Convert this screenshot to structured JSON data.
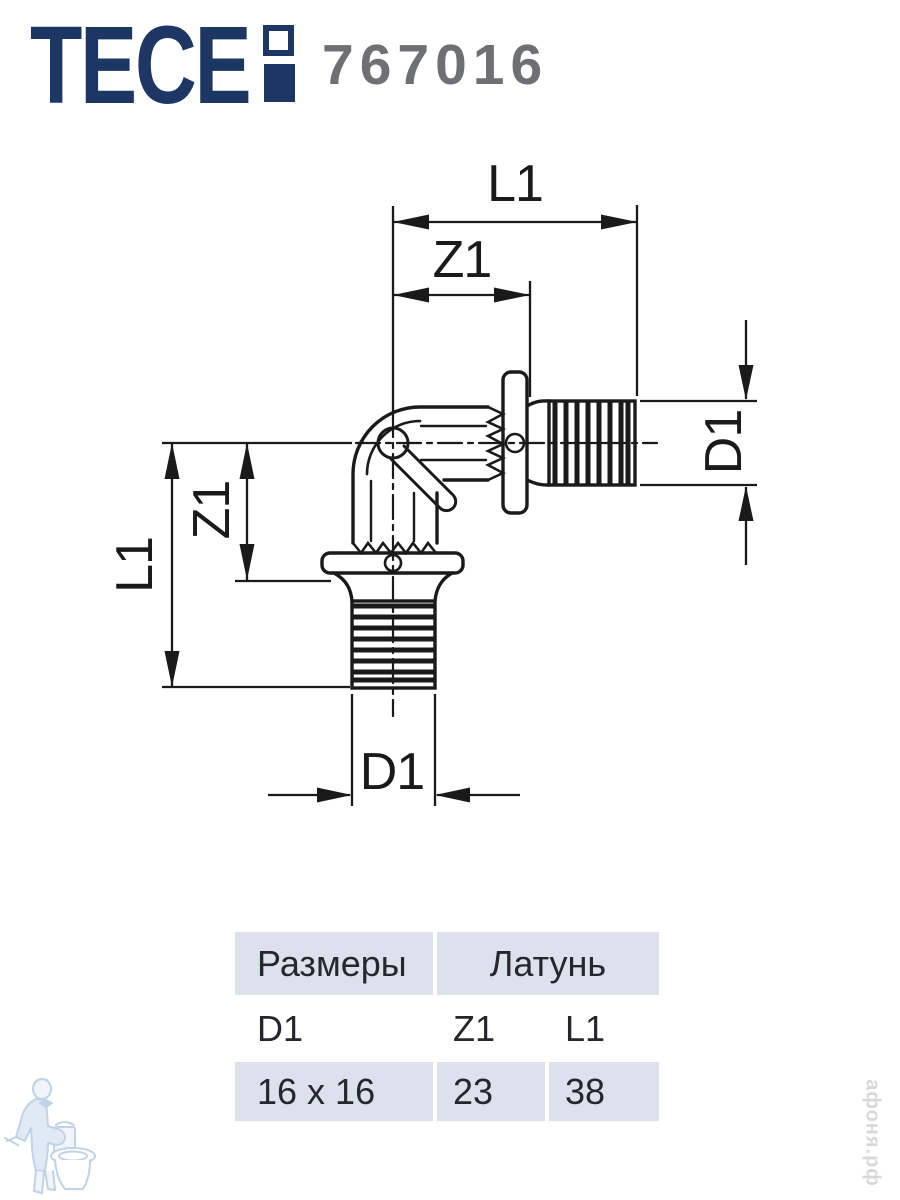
{
  "header": {
    "brand": "TECE",
    "code": "767016"
  },
  "drawing": {
    "description": "90-degree elbow fitting, two barbed press ends, side view with dimension lines",
    "dim_labels": {
      "top_length": "L1",
      "top_offset": "Z1",
      "right_diameter": "D1",
      "left_length": "L1",
      "left_offset": "Z1",
      "bottom_diameter": "D1"
    }
  },
  "table": {
    "headers": {
      "sizes": "Размеры",
      "material": "Латунь"
    },
    "dims": [
      "D1",
      "Z1",
      "L1"
    ],
    "values": [
      "16 x 16",
      "23",
      "38"
    ]
  },
  "watermark": {
    "site_text": "афоня.рф"
  },
  "colors": {
    "brand_navy": "#1d3765",
    "code_gray": "#6f7073",
    "table_header_bg": "#dbe2ec",
    "table_text": "#26262e",
    "drawing_line": "#1a1a1a",
    "watermark_blue": "#b9cfe4",
    "watermark_gray": "#d8d8d8"
  }
}
